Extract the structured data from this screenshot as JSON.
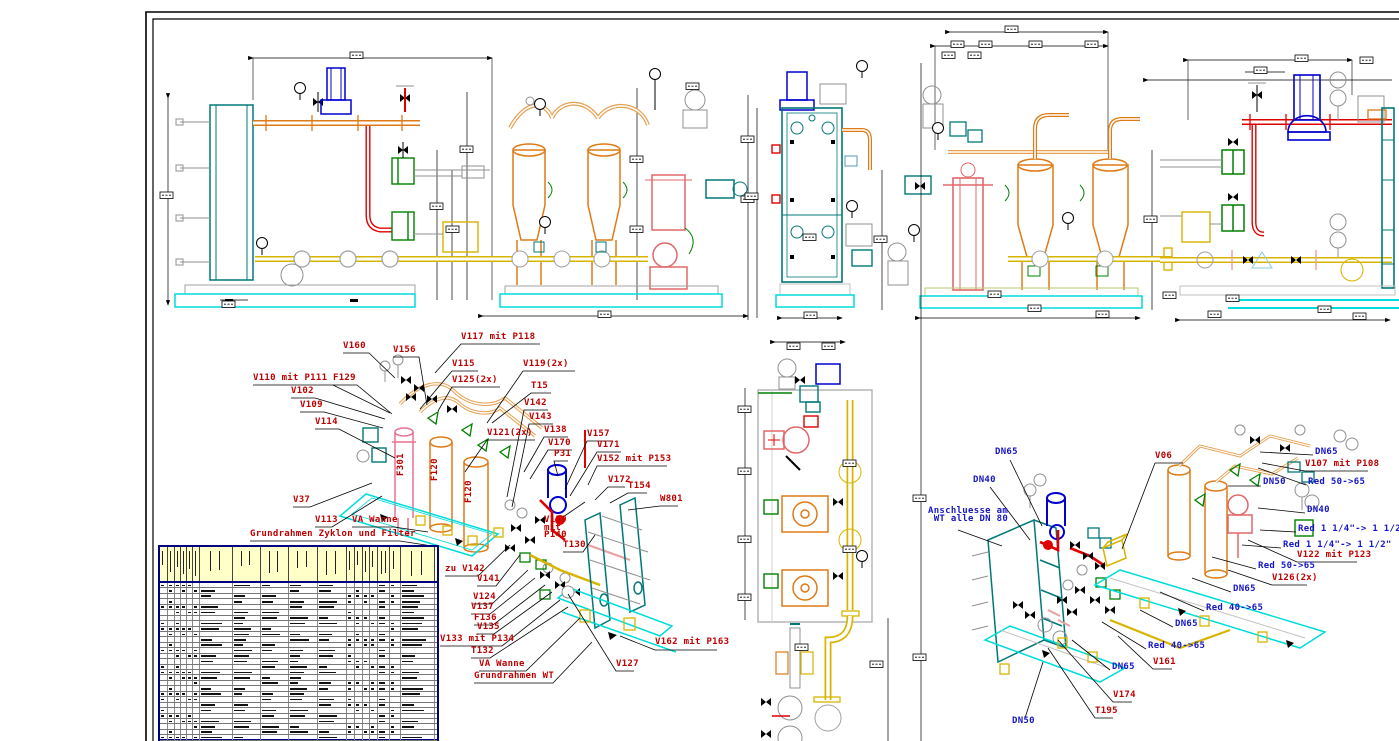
{
  "drawing": {
    "type": "cad-plant-piping-drawing",
    "language": "de",
    "palette": {
      "pipe_orange": "#df7a16",
      "pipe_tan": "#e8a050",
      "pipe_yellow": "#d8b400",
      "pipe_red": "#e00000",
      "vessel_pink": "#e06868",
      "pump_blue": "#0000d0",
      "hx_teal": "#007878",
      "base_cyan": "#00dcdc",
      "valve_green": "#008000",
      "gray": "#909090",
      "light_gray": "#c0c0c0",
      "label_red": "#c00000",
      "label_blue": "#1616c8",
      "table_header": "#ffffc8",
      "table_border": "#000080"
    }
  },
  "table": {
    "name": "parts-list",
    "columns": [
      8,
      7,
      6,
      6,
      6,
      7,
      33,
      28,
      28,
      29,
      29,
      8,
      8,
      7,
      8,
      12,
      11,
      34
    ],
    "rows": 29
  },
  "annotations": [
    {
      "text": "V160",
      "x": 343,
      "y": 343,
      "color": "red",
      "leader": [
        [
          343,
          353
        ],
        [
          369,
          353
        ],
        [
          395,
          378
        ]
      ]
    },
    {
      "text": "V156",
      "x": 393,
      "y": 347,
      "color": "red",
      "leader": [
        [
          393,
          357
        ],
        [
          419,
          357
        ],
        [
          427,
          405
        ]
      ]
    },
    {
      "text": "V117 mit P118",
      "x": 461,
      "y": 334,
      "color": "red",
      "leader": [
        [
          540,
          344
        ],
        [
          461,
          344
        ],
        [
          435,
          373
        ]
      ]
    },
    {
      "text": "V115",
      "x": 452,
      "y": 361,
      "color": "red",
      "leader": [
        [
          478,
          371
        ],
        [
          452,
          371
        ],
        [
          420,
          409
        ]
      ]
    },
    {
      "text": "V119(2x)",
      "x": 523,
      "y": 361,
      "color": "red",
      "leader": [
        [
          575,
          371
        ],
        [
          523,
          371
        ],
        [
          487,
          423
        ]
      ]
    },
    {
      "text": "V110 mit P111",
      "x": 253,
      "y": 375,
      "color": "red",
      "leader": [
        [
          253,
          385
        ],
        [
          333,
          385
        ],
        [
          390,
          413
        ]
      ]
    },
    {
      "text": "F129",
      "x": 333,
      "y": 375,
      "color": "red",
      "leader": [
        [
          333,
          385
        ],
        [
          357,
          385
        ],
        [
          392,
          414
        ]
      ]
    },
    {
      "text": "V125(2x)",
      "x": 452,
      "y": 377,
      "color": "red",
      "leader": [
        [
          500,
          387
        ],
        [
          452,
          387
        ],
        [
          438,
          411
        ]
      ]
    },
    {
      "text": "T15",
      "x": 531,
      "y": 383,
      "color": "red",
      "leader": [
        [
          551,
          393
        ],
        [
          531,
          393
        ],
        [
          492,
          423
        ]
      ]
    },
    {
      "text": "V102",
      "x": 291,
      "y": 388,
      "color": "red",
      "leader": [
        [
          291,
          398
        ],
        [
          315,
          398
        ],
        [
          385,
          419
        ]
      ]
    },
    {
      "text": "V109",
      "x": 300,
      "y": 402,
      "color": "red",
      "leader": [
        [
          300,
          412
        ],
        [
          324,
          412
        ],
        [
          383,
          428
        ]
      ]
    },
    {
      "text": "V142",
      "x": 524,
      "y": 400,
      "color": "red",
      "leader": [
        [
          548,
          410
        ],
        [
          524,
          410
        ],
        [
          507,
          497
        ]
      ]
    },
    {
      "text": "V143",
      "x": 529,
      "y": 414,
      "color": "red",
      "leader": [
        [
          553,
          424
        ],
        [
          529,
          424
        ],
        [
          512,
          507
        ]
      ]
    },
    {
      "text": "V114",
      "x": 315,
      "y": 419,
      "color": "red",
      "leader": [
        [
          315,
          429
        ],
        [
          339,
          429
        ],
        [
          395,
          458
        ]
      ]
    },
    {
      "text": "V121(2x)",
      "x": 487,
      "y": 430,
      "color": "red",
      "leader": [
        [
          535,
          440
        ],
        [
          487,
          440
        ],
        [
          465,
          472
        ]
      ]
    },
    {
      "text": "V138",
      "x": 544,
      "y": 427,
      "color": "red",
      "leader": [
        [
          568,
          437
        ],
        [
          544,
          437
        ],
        [
          524,
          472
        ]
      ]
    },
    {
      "text": "V157",
      "x": 587,
      "y": 431,
      "color": "red",
      "leader": [
        [
          611,
          441
        ],
        [
          587,
          441
        ],
        [
          565,
          489
        ]
      ]
    },
    {
      "text": "V170",
      "x": 548,
      "y": 440,
      "color": "red",
      "leader": [
        [
          572,
          450
        ],
        [
          548,
          450
        ],
        [
          530,
          479
        ]
      ]
    },
    {
      "text": "P31",
      "x": 554,
      "y": 451,
      "color": "red",
      "leader": [
        [
          568,
          461
        ],
        [
          554,
          461
        ],
        [
          558,
          476
        ]
      ]
    },
    {
      "text": "V171",
      "x": 597,
      "y": 442,
      "color": "red",
      "leader": [
        [
          621,
          452
        ],
        [
          597,
          452
        ],
        [
          570,
          496
        ]
      ]
    },
    {
      "text": "V152 mit P153",
      "x": 597,
      "y": 456,
      "color": "red",
      "leader": [
        [
          667,
          466
        ],
        [
          597,
          466
        ],
        [
          588,
          485
        ]
      ]
    },
    {
      "text": "V172",
      "x": 608,
      "y": 477,
      "color": "red",
      "leader": [
        [
          625,
          487
        ],
        [
          608,
          487
        ],
        [
          595,
          500
        ]
      ]
    },
    {
      "text": "T154",
      "x": 628,
      "y": 483,
      "color": "red",
      "leader": [
        [
          647,
          493
        ],
        [
          628,
          493
        ],
        [
          610,
          503
        ]
      ]
    },
    {
      "text": "W801",
      "x": 660,
      "y": 496,
      "color": "red",
      "leader": [
        [
          678,
          506
        ],
        [
          660,
          506
        ],
        [
          628,
          510
        ]
      ]
    },
    {
      "text": "V37",
      "x": 293,
      "y": 497,
      "color": "red",
      "leader": [
        [
          293,
          507
        ],
        [
          310,
          507
        ],
        [
          372,
          483
        ]
      ]
    },
    {
      "text": "V113",
      "x": 315,
      "y": 517,
      "color": "red",
      "leader": [
        [
          315,
          527
        ],
        [
          332,
          527
        ],
        [
          382,
          496
        ]
      ]
    },
    {
      "text": "VA Wanne",
      "x": 352,
      "y": 517,
      "color": "red",
      "leader": [
        [
          352,
          527
        ],
        [
          394,
          527
        ],
        [
          428,
          532
        ]
      ]
    },
    {
      "text": "Grundrahmen Zyklon und Filter",
      "x": 250,
      "y": 531,
      "color": "red",
      "leader": [
        [
          250,
          541
        ],
        [
          400,
          541
        ],
        [
          432,
          546
        ]
      ]
    },
    {
      "text": "V139\nmit\nP140",
      "x": 544,
      "y": 517,
      "color": "red",
      "leader": [
        [
          563,
          517
        ],
        [
          585,
          502
        ]
      ]
    },
    {
      "text": "T130",
      "x": 563,
      "y": 542,
      "color": "red",
      "leader": [
        [
          563,
          552
        ],
        [
          583,
          552
        ],
        [
          595,
          535
        ]
      ]
    },
    {
      "text": "zu V142",
      "x": 445,
      "y": 566,
      "color": "red",
      "leader": [
        [
          445,
          576
        ],
        [
          478,
          576
        ],
        [
          510,
          545
        ]
      ]
    },
    {
      "text": "V141",
      "x": 477,
      "y": 576,
      "color": "red",
      "leader": [
        [
          477,
          586
        ],
        [
          496,
          586
        ],
        [
          520,
          555
        ]
      ]
    },
    {
      "text": "V124",
      "x": 473,
      "y": 594,
      "color": "red",
      "leader": [
        [
          473,
          604
        ],
        [
          492,
          604
        ],
        [
          528,
          570
        ]
      ]
    },
    {
      "text": "V137",
      "x": 471,
      "y": 604,
      "color": "red",
      "leader": [
        [
          471,
          614
        ],
        [
          490,
          614
        ],
        [
          535,
          578
        ]
      ]
    },
    {
      "text": "F136",
      "x": 474,
      "y": 615,
      "color": "red",
      "leader": [
        [
          474,
          625
        ],
        [
          493,
          625
        ],
        [
          545,
          585
        ]
      ]
    },
    {
      "text": "V135",
      "x": 477,
      "y": 624,
      "color": "red",
      "leader": [
        [
          477,
          634
        ],
        [
          494,
          634
        ],
        [
          552,
          592
        ]
      ]
    },
    {
      "text": "V133 mit P134",
      "x": 440,
      "y": 636,
      "color": "red",
      "leader": [
        [
          440,
          646
        ],
        [
          502,
          646
        ],
        [
          560,
          600
        ]
      ]
    },
    {
      "text": "T132",
      "x": 471,
      "y": 648,
      "color": "red",
      "leader": [
        [
          471,
          658
        ],
        [
          490,
          658
        ],
        [
          568,
          607
        ]
      ]
    },
    {
      "text": "VA Wanne",
      "x": 479,
      "y": 661,
      "color": "red",
      "leader": [
        [
          479,
          671
        ],
        [
          526,
          671
        ],
        [
          580,
          618
        ]
      ]
    },
    {
      "text": "Grundrahmen WT",
      "x": 474,
      "y": 673,
      "color": "red",
      "leader": [
        [
          474,
          683
        ],
        [
          553,
          683
        ],
        [
          592,
          642
        ]
      ]
    },
    {
      "text": "V162 mit P163",
      "x": 655,
      "y": 639,
      "color": "red",
      "leader": [
        [
          717,
          650
        ],
        [
          655,
          650
        ],
        [
          620,
          636
        ]
      ]
    },
    {
      "text": "V127",
      "x": 616,
      "y": 661,
      "color": "red",
      "leader": [
        [
          634,
          671
        ],
        [
          616,
          671
        ],
        [
          568,
          594
        ]
      ]
    },
    {
      "text": "F301",
      "x": 398,
      "y": 476,
      "color": "red",
      "rotate": -90
    },
    {
      "text": "F120",
      "x": 432,
      "y": 481,
      "color": "red",
      "rotate": -90
    },
    {
      "text": "F120",
      "x": 466,
      "y": 503,
      "color": "red",
      "rotate": -90
    },
    {
      "text": "DN65",
      "x": 995,
      "y": 449,
      "color": "blue",
      "leader": [
        [
          1010,
          460
        ],
        [
          1042,
          526
        ]
      ]
    },
    {
      "text": "DN40",
      "x": 973,
      "y": 477,
      "color": "blue",
      "leader": [
        [
          990,
          487
        ],
        [
          1030,
          540
        ]
      ]
    },
    {
      "text": "Anschluesse am\n WT alle DN 80",
      "x": 928,
      "y": 508,
      "color": "blue",
      "leader": [
        [
          958,
          530
        ],
        [
          1002,
          546
        ]
      ]
    },
    {
      "text": "DN65",
      "x": 1315,
      "y": 449,
      "color": "blue",
      "leader": [
        [
          1313,
          455
        ],
        [
          1260,
          452
        ]
      ]
    },
    {
      "text": "V107 mit P108",
      "x": 1305,
      "y": 461,
      "color": "red",
      "leader": [
        [
          1368,
          471
        ],
        [
          1305,
          471
        ],
        [
          1262,
          463
        ]
      ]
    },
    {
      "text": "Red 50->65",
      "x": 1308,
      "y": 479,
      "color": "blue",
      "leader": [
        [
          1306,
          485
        ],
        [
          1258,
          468
        ]
      ]
    },
    {
      "text": "DN50",
      "x": 1263,
      "y": 479,
      "color": "blue",
      "leader": [
        [
          1261,
          486
        ],
        [
          1228,
          486
        ]
      ]
    },
    {
      "text": "DN40",
      "x": 1307,
      "y": 507,
      "color": "blue",
      "leader": [
        [
          1305,
          513
        ],
        [
          1258,
          508
        ]
      ]
    },
    {
      "text": "Red 1 1/4\"-> 1 1/2\"",
      "x": 1298,
      "y": 526,
      "color": "blue",
      "leader": [
        [
          1296,
          532
        ],
        [
          1260,
          530
        ]
      ]
    },
    {
      "text": "Red 1 1/4\"-> 1 1/2\"",
      "x": 1283,
      "y": 542,
      "color": "blue",
      "leader": [
        [
          1281,
          548
        ],
        [
          1242,
          545
        ]
      ]
    },
    {
      "text": "V122 mit P123",
      "x": 1297,
      "y": 552,
      "color": "red",
      "leader": [
        [
          1357,
          562
        ],
        [
          1297,
          562
        ],
        [
          1248,
          540
        ]
      ]
    },
    {
      "text": "Red 50->65",
      "x": 1258,
      "y": 563,
      "color": "blue",
      "leader": [
        [
          1256,
          569
        ],
        [
          1212,
          557
        ]
      ]
    },
    {
      "text": "V126(2x)",
      "x": 1272,
      "y": 575,
      "color": "red",
      "leader": [
        [
          1307,
          585
        ],
        [
          1272,
          585
        ],
        [
          1228,
          570
        ]
      ]
    },
    {
      "text": "DN65",
      "x": 1233,
      "y": 586,
      "color": "blue",
      "leader": [
        [
          1231,
          592
        ],
        [
          1192,
          578
        ]
      ]
    },
    {
      "text": "Red 40->65",
      "x": 1206,
      "y": 605,
      "color": "blue",
      "leader": [
        [
          1204,
          611
        ],
        [
          1160,
          592
        ]
      ]
    },
    {
      "text": "DN65",
      "x": 1175,
      "y": 621,
      "color": "blue",
      "leader": [
        [
          1173,
          627
        ],
        [
          1140,
          610
        ]
      ]
    },
    {
      "text": "Red 40->65",
      "x": 1148,
      "y": 643,
      "color": "blue",
      "leader": [
        [
          1146,
          649
        ],
        [
          1102,
          622
        ]
      ]
    },
    {
      "text": "DN65",
      "x": 1112,
      "y": 664,
      "color": "blue",
      "leader": [
        [
          1110,
          670
        ],
        [
          1072,
          640
        ]
      ]
    },
    {
      "text": "V161",
      "x": 1153,
      "y": 659,
      "color": "red",
      "leader": [
        [
          1172,
          669
        ],
        [
          1153,
          669
        ],
        [
          1118,
          636
        ]
      ]
    },
    {
      "text": "V174",
      "x": 1113,
      "y": 692,
      "color": "red",
      "leader": [
        [
          1132,
          702
        ],
        [
          1113,
          702
        ],
        [
          1058,
          640
        ]
      ]
    },
    {
      "text": "T195",
      "x": 1095,
      "y": 708,
      "color": "red",
      "leader": [
        [
          1113,
          718
        ],
        [
          1095,
          718
        ],
        [
          1048,
          648
        ]
      ]
    },
    {
      "text": "DN50",
      "x": 1012,
      "y": 718,
      "color": "blue",
      "leader": [
        [
          1025,
          718
        ],
        [
          1043,
          662
        ]
      ]
    },
    {
      "text": "V06",
      "x": 1155,
      "y": 453,
      "color": "red",
      "leader": [
        [
          1183,
          463
        ],
        [
          1155,
          463
        ],
        [
          1122,
          549
        ]
      ]
    }
  ]
}
